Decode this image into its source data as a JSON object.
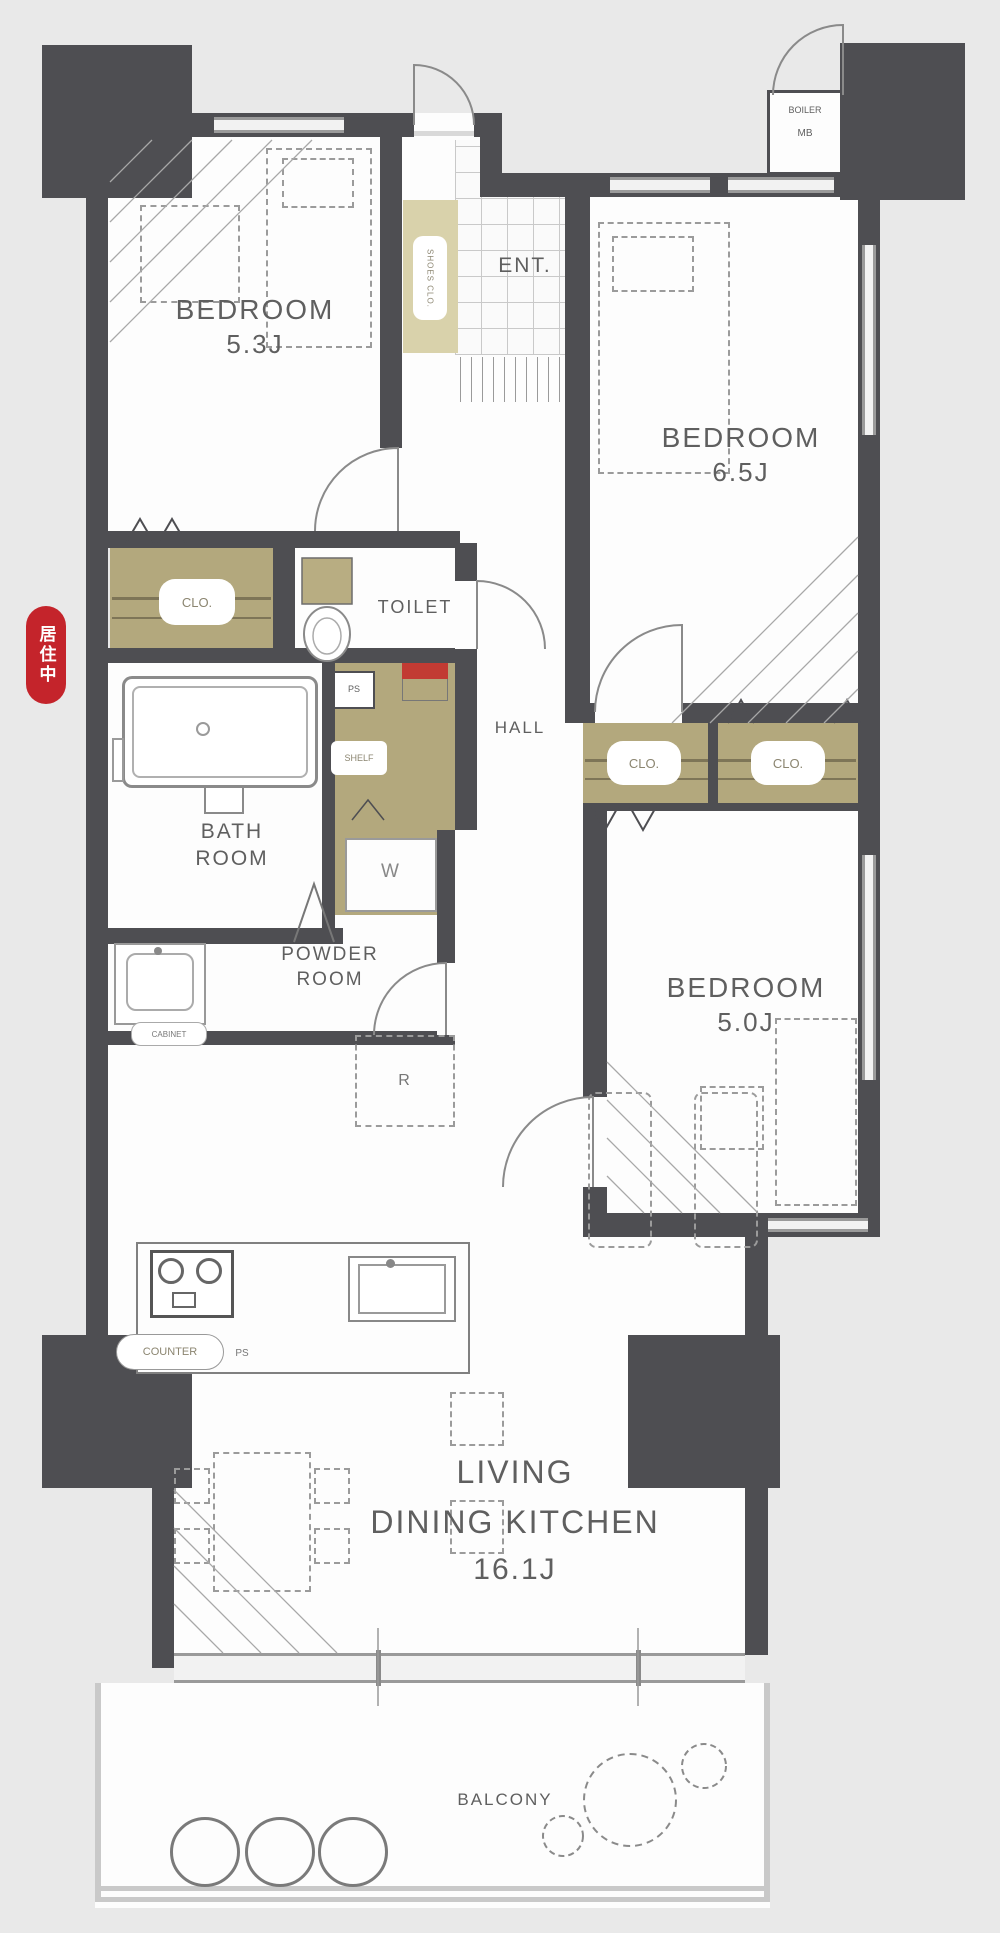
{
  "palette": {
    "background": "#e9e9e9",
    "wall": "#4e4e52",
    "floor": "#fdfdfd",
    "closet_tan": "#b3a87d",
    "closet_light": "#d9d2ab",
    "badge_red": "#c4242b",
    "accent_red": "#c23b33",
    "line_gray": "#8a8a8a",
    "label_gray": "#5f5f5f"
  },
  "badge": {
    "text": "居住中"
  },
  "rooms": {
    "bedroom_53": {
      "name": "BEDROOM",
      "size": "5.3J"
    },
    "bedroom_65": {
      "name": "BEDROOM",
      "size": "6.5J"
    },
    "bedroom_50": {
      "name": "BEDROOM",
      "size": "5.0J"
    },
    "ldk": {
      "name_line1": "LIVING",
      "name_line2": "DINING KITCHEN",
      "size": "16.1J"
    },
    "entrance": {
      "name": "ENT."
    },
    "hall": {
      "name": "HALL"
    },
    "toilet": {
      "name": "TOILET"
    },
    "bathroom": {
      "name_line1": "BATH",
      "name_line2": "ROOM"
    },
    "powder_room": {
      "name_line1": "POWDER",
      "name_line2": "ROOM"
    },
    "balcony": {
      "name": "BALCONY"
    }
  },
  "labels": {
    "shoes_closet": "SHOES CLO.",
    "closet": "CLO.",
    "shelf": "SHELF",
    "washer": "W",
    "refrigerator": "R",
    "pipe_space": "PS",
    "counter": "COUNTER",
    "counter_ps": "PS",
    "cabinet": "CABINET",
    "boiler": "BOILER",
    "meter_box": "MB"
  }
}
